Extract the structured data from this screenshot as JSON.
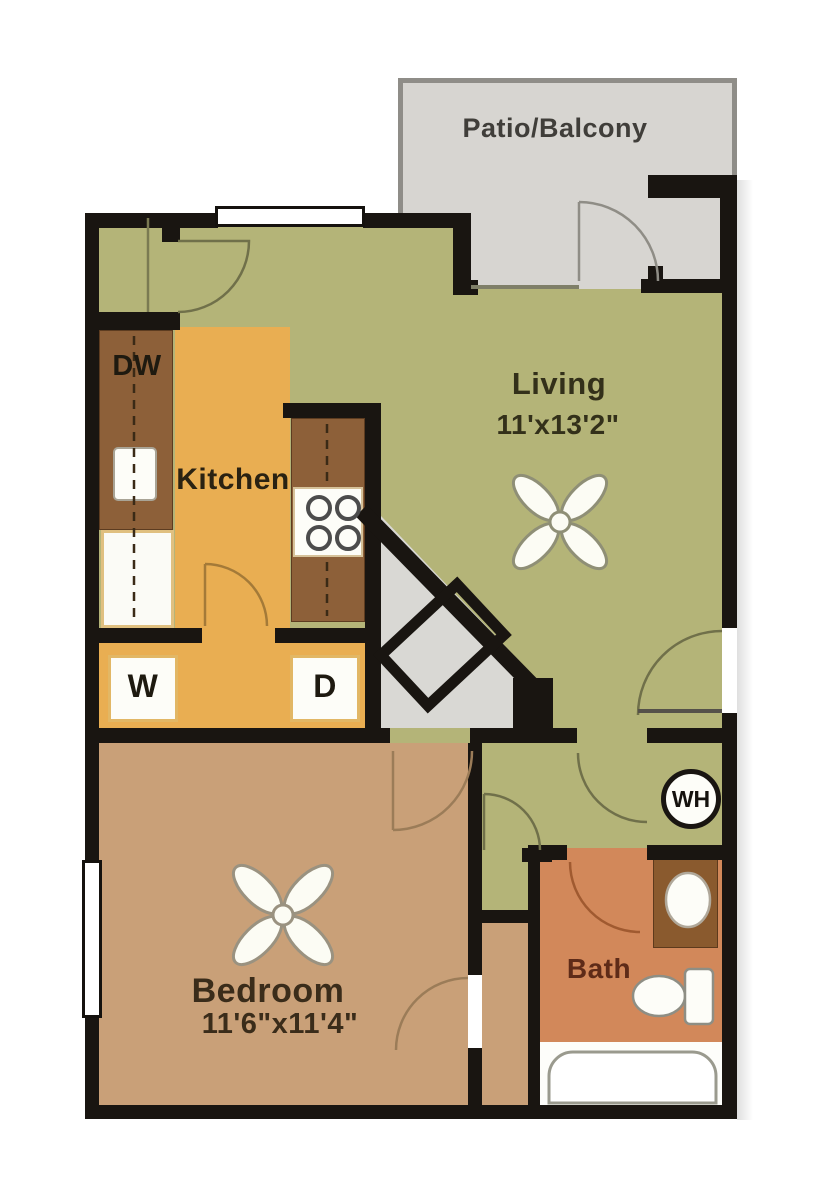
{
  "plan_title": "One bedroom apartment floor plan",
  "rooms": {
    "patio": {
      "label": "Patio/Balcony"
    },
    "living": {
      "label": "Living",
      "dimensions": "11'x13'2\""
    },
    "kitchen": {
      "label": "Kitchen"
    },
    "bedroom": {
      "label": "Bedroom",
      "dimensions": "11'6\"x11'4\""
    },
    "bath": {
      "label": "Bath"
    }
  },
  "fixtures": {
    "dishwasher": "DW",
    "washer": "W",
    "dryer": "D",
    "water_heater": "WH"
  },
  "colors": {
    "wall": "#191511",
    "living_floor": "#b4b478",
    "kitchen_floor": "#e9ae52",
    "bedroom_floor": "#c9a078",
    "bath_floor": "#d2885a",
    "patio_floor": "#d7d5d1",
    "entry_floor": "#d9d8d4",
    "counter": "#8d6039",
    "vanity": "#8a5a2e"
  }
}
